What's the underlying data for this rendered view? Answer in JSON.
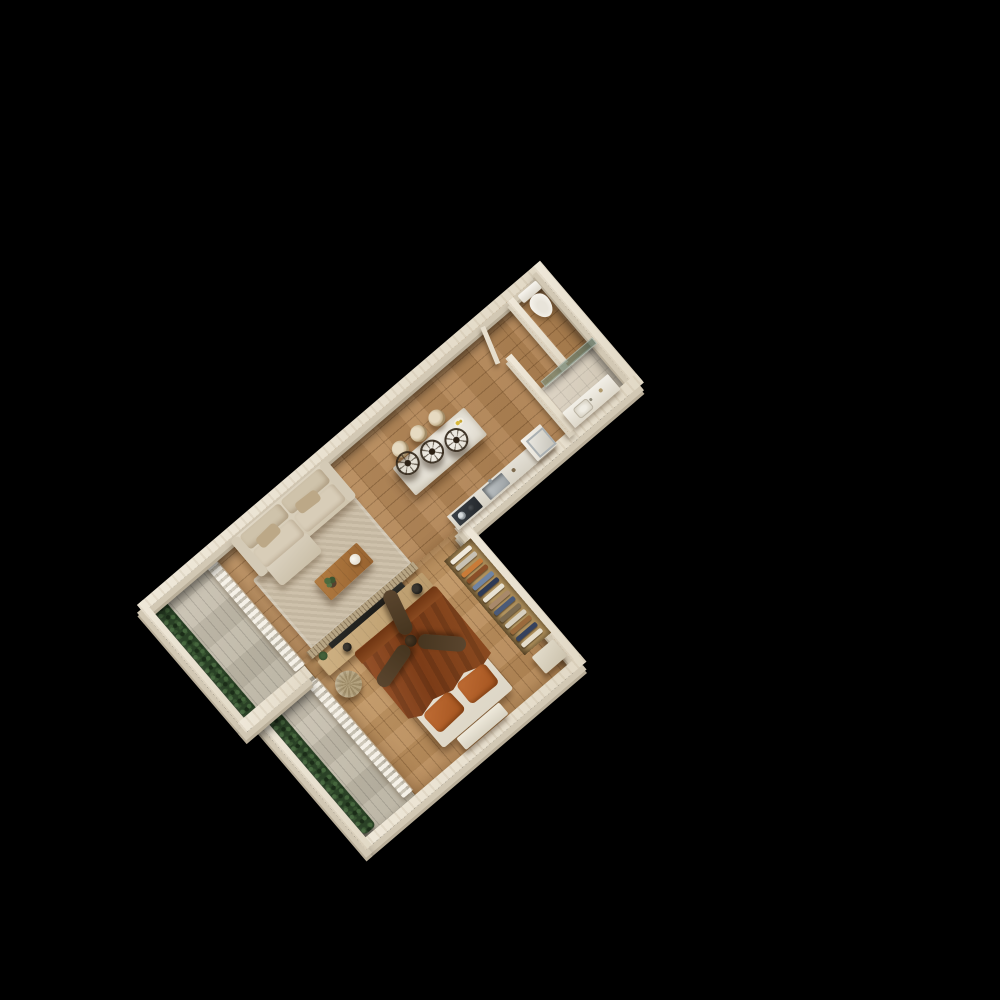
{
  "scene": {
    "description": "3D isometric top-down render of a one-bedroom apartment floor plan, rotated diagonally on a pure black background",
    "background_color": "#000000",
    "rotation_degrees": -40.5
  },
  "palette": {
    "wall": "#ebe3d3",
    "wall_face": "#d2c8b4",
    "wood_floor": "#b28355",
    "bedroom_floor": "#c09767",
    "balcony_deck": "#c6bfae",
    "shower_tile": "#d8cfc0",
    "hedge_green": "#2a4126",
    "sofa_beige": "#dbd2c0",
    "rug": "#cbbda6",
    "table_wood": "#a8713a",
    "island_stone": "#e9e5db",
    "counter": "#e0dcd2",
    "steel": "#b9bec0",
    "cooktop": "#32373c",
    "bed_blanket": "#8a4a21",
    "pillow_orange": "#b2612c",
    "bed_sheet": "#eae5d8",
    "fan_wood": "#53402b",
    "console_wood": "#c9ab7d",
    "tv_screen": "#23231f",
    "curtain": "#f2ede1",
    "shower_glass": "#829682",
    "porcelain": "#f4f1ea"
  },
  "rooms": [
    {
      "id": "living-room",
      "furniture": [
        "sofa",
        "coffee-table",
        "rug",
        "tv-console",
        "slat-screen",
        "pouf"
      ]
    },
    {
      "id": "kitchen",
      "furniture": [
        "island",
        "bar-stools",
        "pendant-lights",
        "sink",
        "cooktop",
        "counter"
      ]
    },
    {
      "id": "hallway",
      "furniture": [
        "washing-machine"
      ]
    },
    {
      "id": "bathroom",
      "furniture": [
        "toilet",
        "shower-glass-panel",
        "vanity-sink"
      ]
    },
    {
      "id": "bedroom",
      "furniture": [
        "double-bed",
        "ceiling-fan",
        "wardrobe",
        "nightstand",
        "foot-bench"
      ]
    },
    {
      "id": "balcony-living",
      "furniture": [
        "hedge-planter"
      ]
    },
    {
      "id": "balcony-bedroom",
      "furniture": [
        "hedge-planter"
      ]
    }
  ],
  "kitchen": {
    "pendant_lights": {
      "count": 3,
      "positions": [
        [
          296,
          66
        ],
        [
          322,
          73
        ],
        [
          348,
          80
        ]
      ]
    },
    "stools": {
      "count": 3,
      "positions": [
        [
          293,
          44
        ],
        [
          317,
          44
        ],
        [
          341,
          44
        ]
      ]
    },
    "counter_items": [
      "cooktop-with-pots",
      "steel-sink",
      "washing-machine"
    ]
  },
  "bedroom": {
    "ceiling_fan": {
      "blades": 3,
      "angles": [
        15,
        135,
        255
      ]
    },
    "wardrobe": {
      "clothes_colors": [
        "#efe9dc",
        "#c8c2b4",
        "#c97b38",
        "#8a4f28",
        "#6f84a3",
        "#2e3a55",
        "#e8e2d3",
        "#a8896a",
        "#4a5a78",
        "#7b6platform",
        "#d8d0c0",
        "#9a6a3c",
        "#35425e",
        "#e5ddcb"
      ]
    }
  }
}
